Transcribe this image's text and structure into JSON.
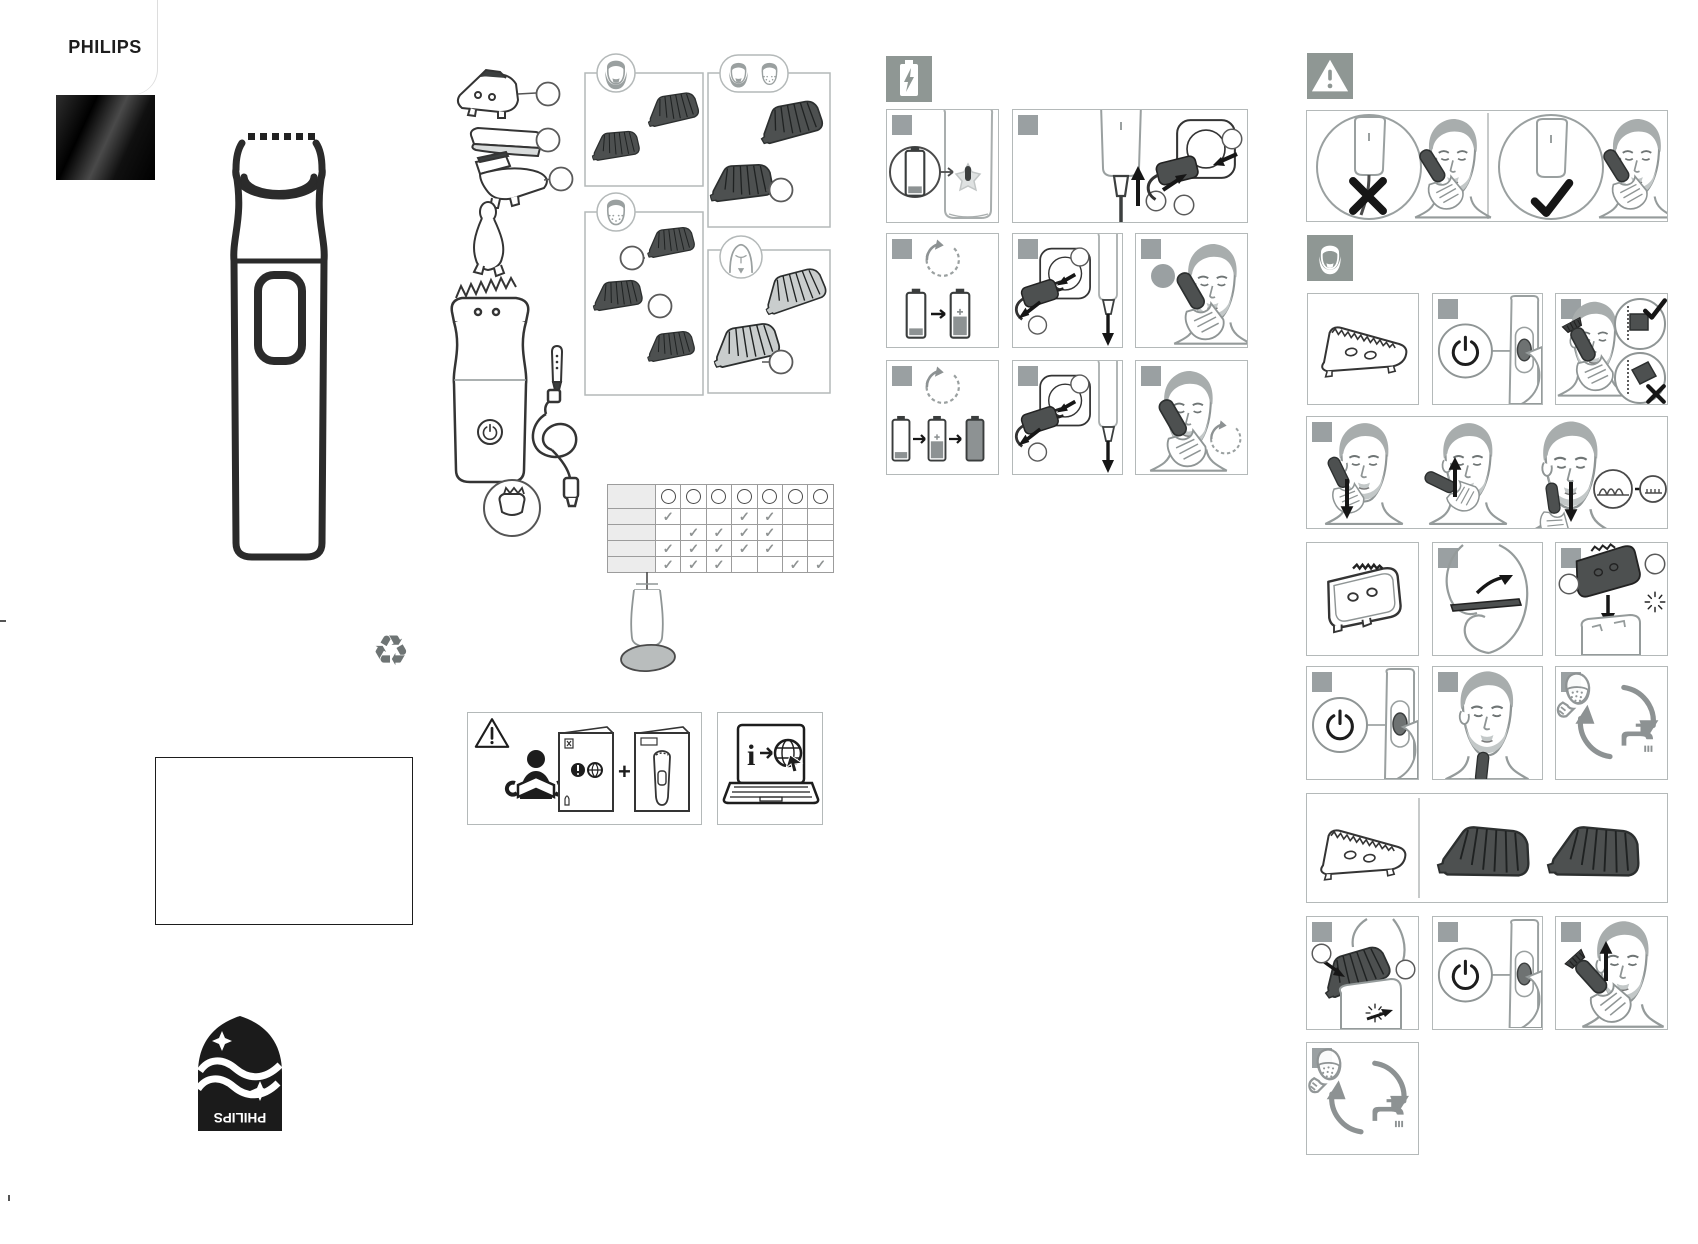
{
  "page": {
    "width": 1698,
    "height": 1244,
    "background": "#ffffff",
    "kind": "quick start leaflet"
  },
  "brand": {
    "wordmark": "PHILIPS",
    "shield_wordmark": "PHILIPS"
  },
  "glyphs": {
    "check": "✓",
    "plus": "+",
    "info": "i",
    "recycle": "♻"
  },
  "colors": {
    "panel_border": "#b4b9b9",
    "badge": "#9aa0a2",
    "icon_box": "#8f9794",
    "line_dark": "#2c2f2f",
    "line_gray": "#9aa0a0",
    "fill_dark": "#4d5050",
    "fill_light_comb": "#c9cdcd",
    "table_label_bg": "#ececec",
    "check": "#8f9393"
  },
  "sections": {
    "front": {
      "items": [
        "brand-card",
        "device-outline",
        "recycle-icon",
        "notes-box",
        "shield-emblem-upside-down"
      ]
    },
    "contents": {
      "parts_with_callouts": 3,
      "accessory_boxes": [
        {
          "icon": "beard-face-icon",
          "combs": 2
        },
        {
          "icon": "stubble-face-icon",
          "combs": 3,
          "callouts": 2
        },
        {
          "icon": "two-faces-icon",
          "combs": 2,
          "callouts": 1
        },
        {
          "icon": "body-icon",
          "combs": 2,
          "callouts": 1
        }
      ],
      "extras": [
        "nose-trimmer",
        "handle-with-comb",
        "cleaning-oil-pen",
        "usb-cable",
        "accessory-callout-circle",
        "oil-bottle"
      ]
    },
    "compatibility_table": {
      "columns": 7,
      "label_rows": 4,
      "checks": [
        [
          1,
          0,
          0,
          1,
          1,
          0,
          0
        ],
        [
          0,
          1,
          1,
          1,
          1,
          0,
          0
        ],
        [
          1,
          1,
          1,
          1,
          1,
          0,
          0
        ],
        [
          1,
          1,
          1,
          0,
          0,
          1,
          1
        ]
      ]
    },
    "read_docs": {
      "panels": [
        "warning-booklet-plus-device-leaflet",
        "laptop-info-online"
      ]
    },
    "charging": {
      "icon": "battery-charging-icon",
      "panel_count": 8
    },
    "safety": {
      "icon": "warning-icon",
      "panels": [
        "corded-use-crossed",
        "cordless-use-checked"
      ]
    },
    "beard_trim": {
      "icon": "beard-icon",
      "panel_count": 14
    }
  }
}
